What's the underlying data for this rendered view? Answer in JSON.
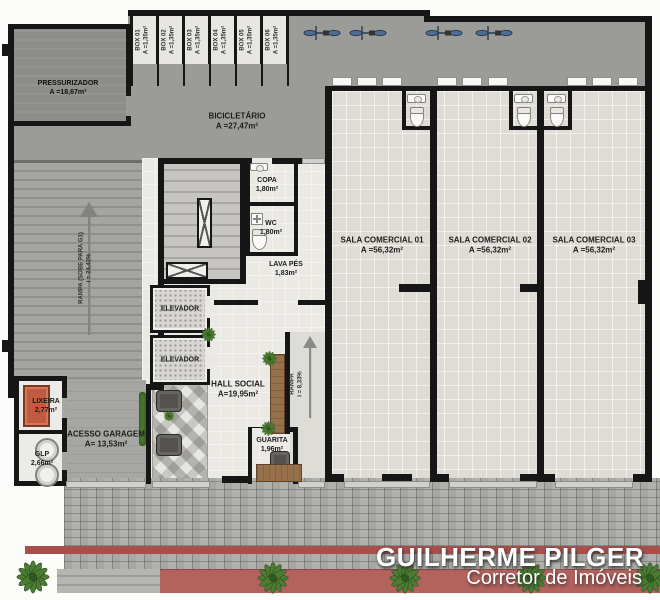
{
  "branding": {
    "name": "GUILHERME PILGER",
    "tagline": "Corretor de Imóveis"
  },
  "rooms": {
    "pressurizador": {
      "name": "PRESSURIZADOR",
      "area": "A =18,67m²"
    },
    "bicicletario": {
      "name": "BICICLETÁRIO",
      "area": "A =27,47m²"
    },
    "copa": {
      "name": "COPA",
      "area": "1,80m²"
    },
    "wc": {
      "name": "WC",
      "area": "1,80m²"
    },
    "lava_pes": {
      "name": "LAVA PÉS",
      "area": "1,83m²"
    },
    "elevador_1": {
      "name": "ELEVADOR"
    },
    "elevador_2": {
      "name": "ELEVADOR"
    },
    "hall_social": {
      "name": "HALL SOCIAL",
      "area": "A=19,95m²"
    },
    "guarita": {
      "name": "GUARITA",
      "area": "1,96m²"
    },
    "lixeira": {
      "name": "LIXEIRA",
      "area": "2,77m²"
    },
    "glp": {
      "name": "GLP",
      "area": "2,66m²"
    },
    "acesso_garagem": {
      "name": "ACESSO GARAGEM",
      "area": "A= 13,53m²"
    }
  },
  "boxes": [
    {
      "name": "BOX 01",
      "area": "A =1,35m²"
    },
    {
      "name": "BOX 02",
      "area": "A =1,35m²"
    },
    {
      "name": "BOX 03",
      "area": "A =1,35m²"
    },
    {
      "name": "BOX 04",
      "area": "A =1,35m²"
    },
    {
      "name": "BOX 05",
      "area": "A =1,35m²"
    },
    {
      "name": "BOX 06",
      "area": "A =1,35m²"
    }
  ],
  "salas": [
    {
      "name": "SALA COMERCIAL 01",
      "area": "A =56,32m²"
    },
    {
      "name": "SALA COMERCIAL 02",
      "area": "A =56,32m²"
    },
    {
      "name": "SALA COMERCIAL 03",
      "area": "A =56,32m²"
    }
  ],
  "ramps": {
    "garagem": {
      "label": "RAMPA (SOBE PARA G1)",
      "slope": "i = 24,42%"
    },
    "entrada": {
      "label": "RAMPA",
      "slope": "i = 8,33%"
    }
  },
  "icons": {
    "bike": "bicycle-top-view",
    "plant": "shrub-top-view",
    "arrow": "direction-arrow-up",
    "toilet": "toilet-plan",
    "sink": "sink-plan"
  },
  "colors": {
    "wall": "#161616",
    "garage_floor": "#9b9b97",
    "sala_floor": "#dfdcd5",
    "hall_floor": "#ebe9e4",
    "sidewalk": "#a7a7a3",
    "accent_red": "#a84f4b",
    "planter_red": "#b4625e",
    "plant_green": "#4c7c33",
    "wood": "#96714c",
    "bike_blue": "#4e6d94",
    "branding_text": "#ffffff"
  }
}
